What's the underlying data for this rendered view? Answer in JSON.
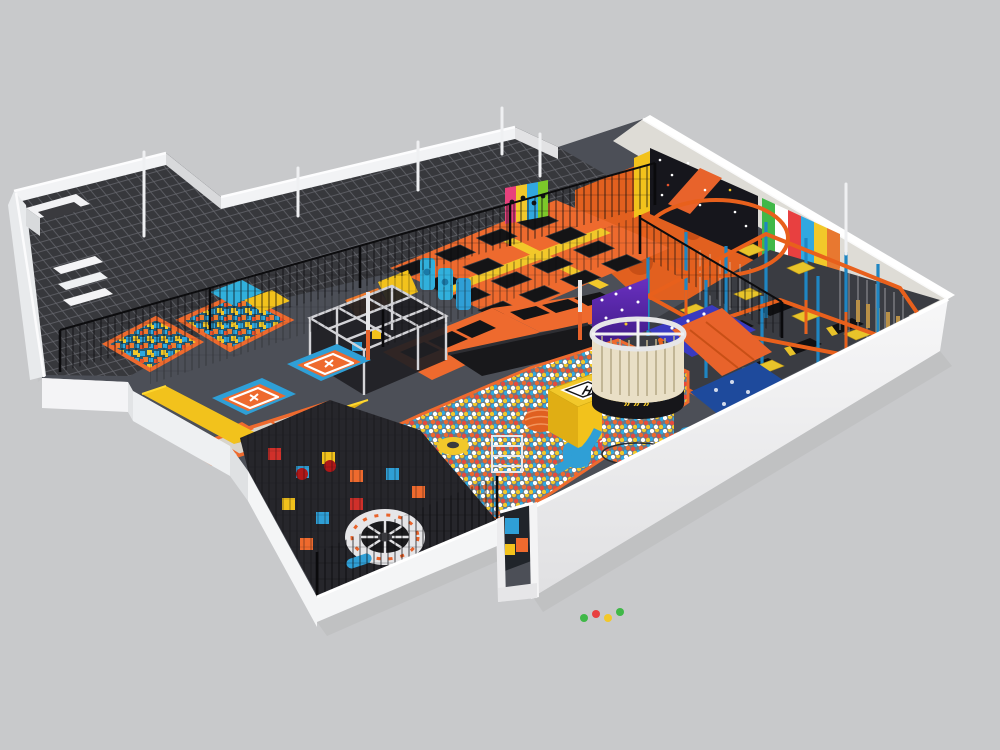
{
  "scene": {
    "helipad_letter": "H",
    "tower_arrows": "»»»"
  },
  "colors": {
    "background": "#c8c9cb",
    "floor": "#4c4f57",
    "roofSlab": "#37383c",
    "roofGridLine": "#63646a",
    "parapetLight": "#f2f3f5",
    "parapetShade": "#d8d9db",
    "innerWall": "#dedcd6",
    "frontWall": "#f4f5f6",
    "wallShadow": "#b9babc",
    "orange": "#ee6a2e",
    "orangeDeep": "#c84f16",
    "orangeFloor": "#e2601f",
    "ropeOrange": "#e8601c",
    "yellow": "#f2c21c",
    "yellowDeep": "#e0ae14",
    "platformYellow": "#e8c42a",
    "blue": "#2f9fd6",
    "cyan": "#31b0dc",
    "navyPit": "#1e4a9c",
    "ledPurple": "#5a2aa0",
    "ledFloorBlue": "#3a3ac0",
    "charcoalZone": "#26262b",
    "bedBlack": "#141416",
    "laneGray": "#d8d4cb",
    "ringWhite": "#e6e6e8",
    "discDark": "#1c1c1e",
    "meshLine": "#0b0b0d",
    "foamBase": "#235a74",
    "ballBase": "#6a7884",
    "poleBlue": "#1f86c2",
    "red": "#d0302a",
    "white": "#ffffff",
    "starWall": "#16161c",
    "candyGreen": "#40b848",
    "candyRed": "#e84040",
    "heliPadWhite": "#ffffff"
  }
}
